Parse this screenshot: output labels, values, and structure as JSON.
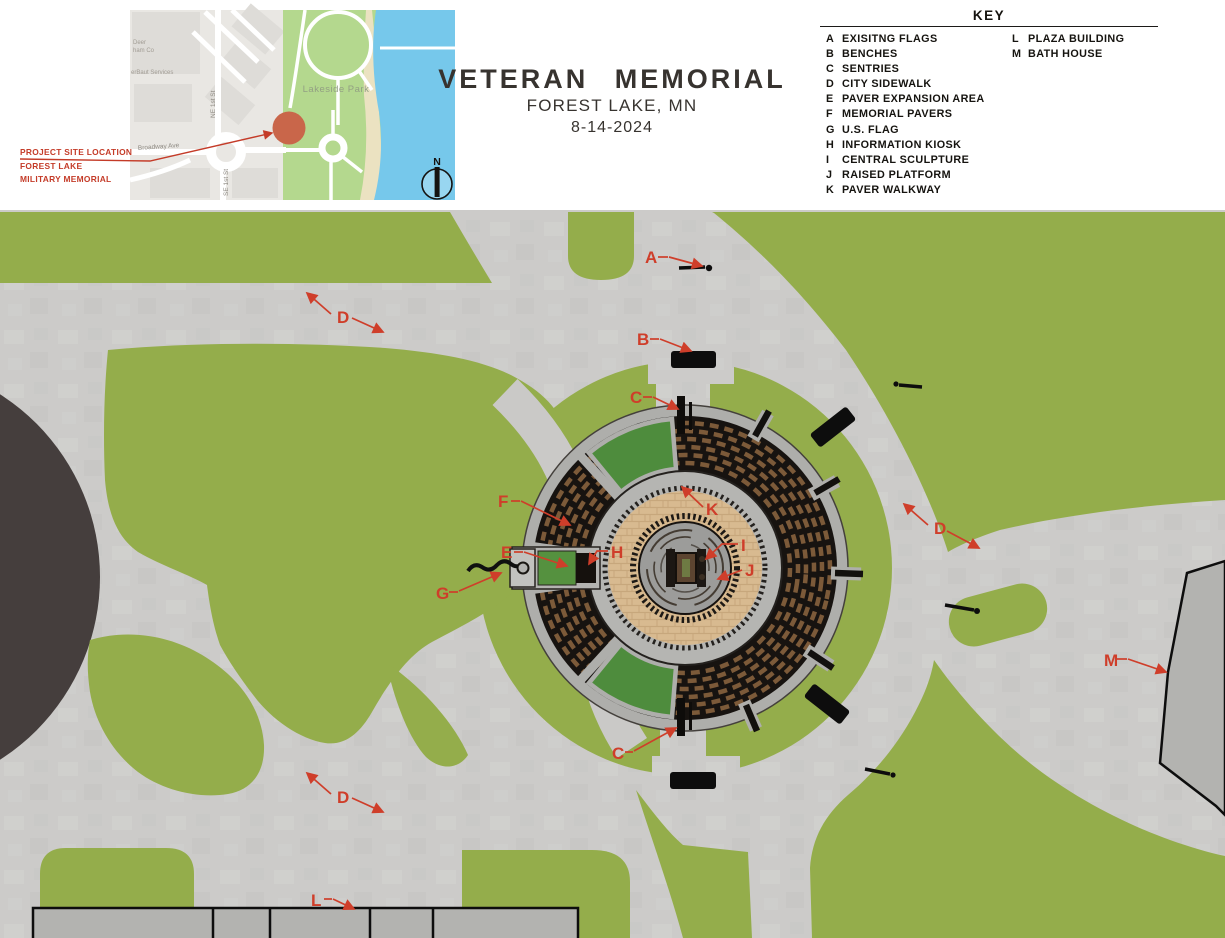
{
  "header": {
    "title": "VETERAN  MEMORIAL",
    "subtitle": "FOREST LAKE, MN",
    "date": "8-14-2024"
  },
  "map": {
    "park_label": "Lakeside Park",
    "street_ne_1st": "NE 1st St",
    "street_broadway": "Broadway Ave",
    "street_se_1st": "SE 1st St",
    "poi_fragment_1": "Deer",
    "poi_fragment_2": "ham Co",
    "poi_fragment_3": "erBaut Services",
    "north_label": "N",
    "callout": {
      "line1": "PROJECT SITE LOCATION",
      "line2": "FOREST LAKE",
      "line3": "MILITARY MEMORIAL"
    }
  },
  "key": {
    "title": "KEY",
    "items": [
      {
        "letter": "A",
        "label": "EXISITNG FLAGS"
      },
      {
        "letter": "B",
        "label": "BENCHES"
      },
      {
        "letter": "C",
        "label": "SENTRIES"
      },
      {
        "letter": "D",
        "label": "CITY SIDEWALK"
      },
      {
        "letter": "E",
        "label": "PAVER EXPANSION AREA"
      },
      {
        "letter": "F",
        "label": "MEMORIAL PAVERS"
      },
      {
        "letter": "G",
        "label": "U.S. FLAG"
      },
      {
        "letter": "H",
        "label": "INFORMATION KIOSK"
      },
      {
        "letter": "I",
        "label": "CENTRAL SCULPTURE"
      },
      {
        "letter": "J",
        "label": "RAISED PLATFORM"
      },
      {
        "letter": "K",
        "label": "PAVER WALKWAY"
      },
      {
        "letter": "L",
        "label": "PLAZA BUILDING"
      },
      {
        "letter": "M",
        "label": "BATH HOUSE"
      }
    ]
  },
  "plan": {
    "labels": [
      {
        "id": "existing-flags",
        "letter": "A"
      },
      {
        "id": "bench-north",
        "letter": "B"
      },
      {
        "id": "sentry-north",
        "letter": "C"
      },
      {
        "id": "sentry-south",
        "letter": "C"
      },
      {
        "id": "city-sidewalk-northwest",
        "letter": "D"
      },
      {
        "id": "city-sidewalk-east",
        "letter": "D"
      },
      {
        "id": "city-sidewalk-southwest",
        "letter": "D"
      },
      {
        "id": "paver-expansion-area",
        "letter": "E"
      },
      {
        "id": "memorial-pavers",
        "letter": "F"
      },
      {
        "id": "us-flag",
        "letter": "G"
      },
      {
        "id": "information-kiosk",
        "letter": "H"
      },
      {
        "id": "central-sculpture",
        "letter": "I"
      },
      {
        "id": "raised-platform",
        "letter": "J"
      },
      {
        "id": "paver-walkway",
        "letter": "K"
      },
      {
        "id": "plaza-building",
        "letter": "L"
      },
      {
        "id": "bath-house",
        "letter": "M"
      }
    ],
    "colors": {
      "grass": "#94ad4b",
      "sidewalk": "#cccbc9",
      "street_asphalt": "#453e3d",
      "memorial_paver_dark": "#171310",
      "memorial_brick": "#7c5a39",
      "plaza_tan": "#d8ba90",
      "planting_green": "#4e8c3d",
      "building_gray": "#b3b3b0",
      "annotation_red": "#cf3e2a",
      "map_park_green": "#b4d88e",
      "map_lake_blue": "#76c8eb",
      "site_marker_orange": "#c9664a"
    }
  }
}
